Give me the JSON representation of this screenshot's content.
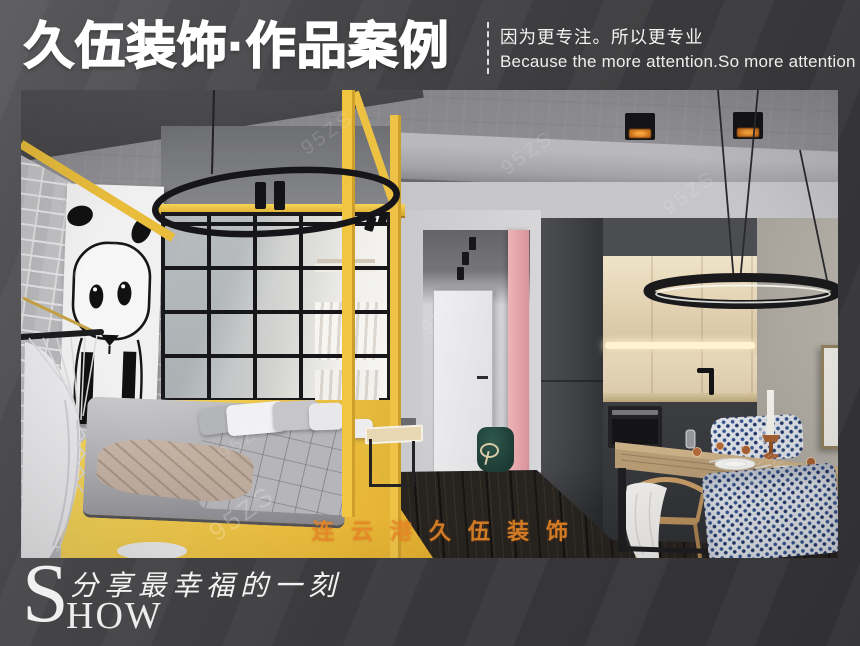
{
  "header": {
    "title": "久伍装饰·作品案例",
    "slogan_cn": "因为更专注。所以更专业",
    "slogan_en": "Because the more attention.So more attention"
  },
  "photo_watermarks": {
    "center": "连云港久伍装饰",
    "diagonal": "95ZS"
  },
  "footer": {
    "show_initial": "S",
    "show_rest": "HOW",
    "tagline": "分享最幸福的一刻"
  },
  "colors": {
    "accent_yellow": "#eec040",
    "accent_pink": "#edb4b8",
    "watermark_orange": "#e88828",
    "background_dark": "#3a3a3c",
    "cabinet_dark": "#3b3d40",
    "pouf_green": "#1c3a32"
  }
}
